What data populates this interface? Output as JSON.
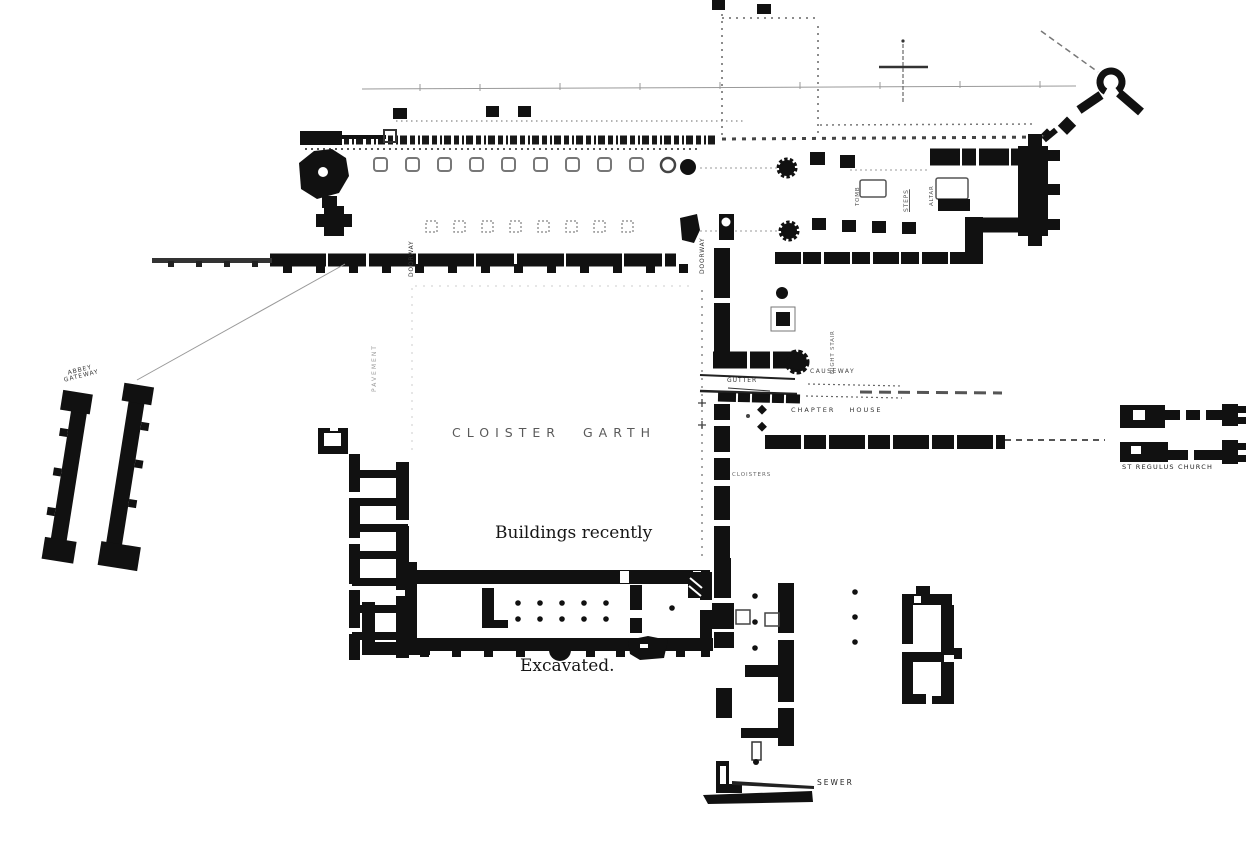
{
  "plan": {
    "colors": {
      "ink": "#111111",
      "paper": "#ffffff",
      "faint": "#888888"
    },
    "garth": {
      "word1": "CLOISTER",
      "word2": "GARTH"
    },
    "caption": {
      "line1": "Buildings recently",
      "line2": "Excavated."
    },
    "gateway": {
      "line1": "ABBEY",
      "line2": "GATEWAY"
    },
    "labels": {
      "st_regulus": "ST REGULUS CHURCH",
      "sewer": "SEWER",
      "cloisters": "CLOISTERS",
      "gutter": "GUTTER",
      "causeway": "CAUSEWAY",
      "chapter_house": "CHAPTER HOUSE",
      "doorway_nave": "DOORWAY",
      "doorway_transept": "DOORWAY",
      "tomb": "TOMB",
      "steps": "STEPS",
      "altar": "ALTAR",
      "night_stair": "NIGHT STAIR",
      "pavement": "PAVEMENT"
    }
  }
}
